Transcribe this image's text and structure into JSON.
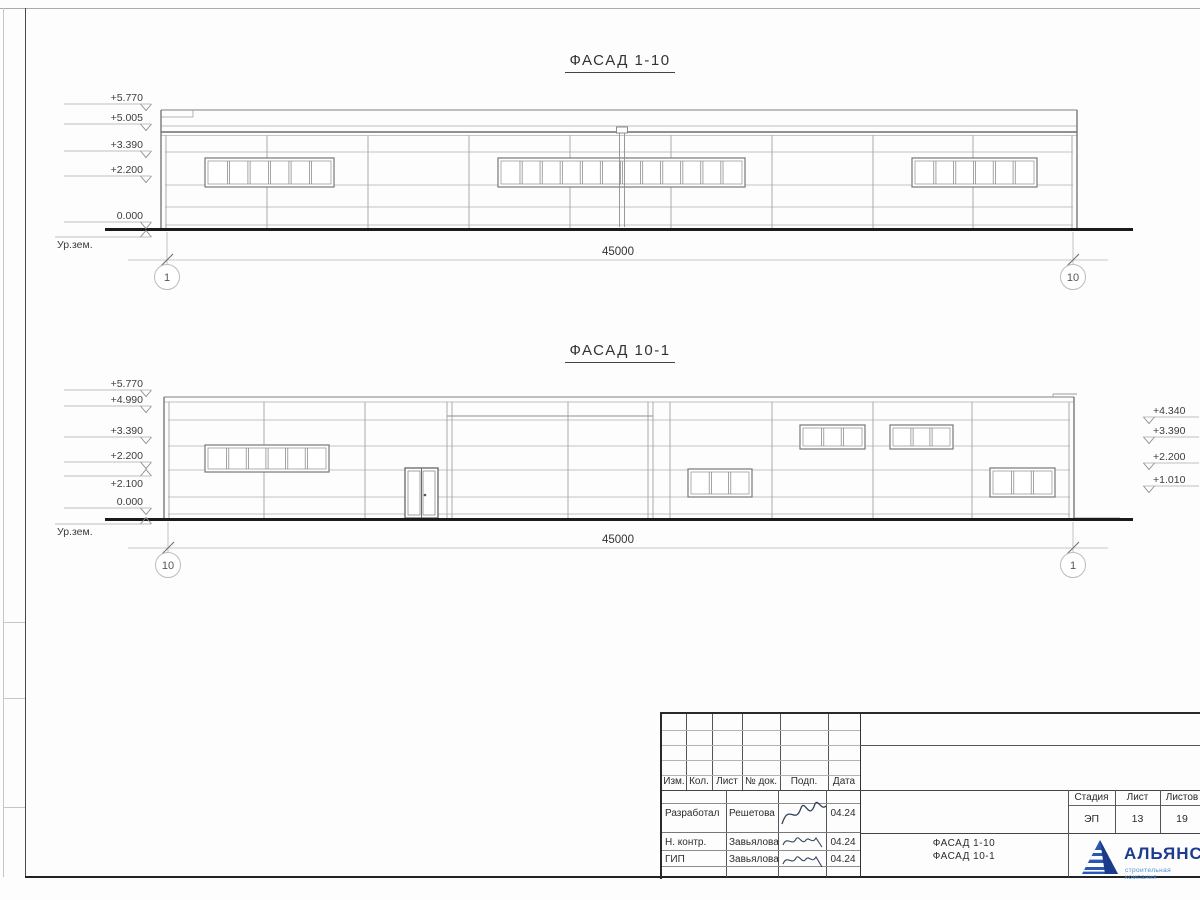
{
  "facades": [
    {
      "id": "facade-1-10",
      "title": "ФАСАД 1-10",
      "outline": {
        "x1": 161,
        "x2": 1077,
        "top": 110,
        "wall_top": 135,
        "ground": 228
      },
      "hlines": [
        152,
        185,
        207,
        225
      ],
      "vlines": [
        166,
        267,
        368,
        469,
        570,
        671,
        772,
        873,
        973,
        1072
      ],
      "lines": [
        [
          161,
          110,
          1077,
          110,
          1,
          "#7f7f7f"
        ],
        [
          161,
          117,
          193,
          117,
          0.8,
          "#9f9f9f"
        ],
        [
          193,
          110,
          193,
          117,
          0.8,
          "#9f9f9f"
        ],
        [
          161,
          126,
          1077,
          126,
          0.8,
          "#a8a8a8"
        ],
        [
          161,
          132,
          1077,
          132,
          1.4,
          "#6e6e6e"
        ],
        [
          161,
          135.5,
          1077,
          135.5,
          0.8,
          "#b5b5b5"
        ]
      ],
      "windows": [
        {
          "x": 205,
          "y": 158,
          "w": 129,
          "h": 29,
          "panes": 6
        },
        {
          "x": 498,
          "y": 158,
          "w": 247,
          "h": 29,
          "panes": 12
        },
        {
          "x": 912,
          "y": 158,
          "w": 125,
          "h": 29,
          "panes": 6
        }
      ],
      "downspout": {
        "x": 622,
        "cap_y": 127,
        "y1": 133,
        "y2": 227
      },
      "ground": {
        "x1": 105,
        "x2": 1133,
        "y": 229.5
      },
      "dim": {
        "y": 260,
        "lx1": 128,
        "lx2": 1108,
        "x1": 167,
        "x2": 1073,
        "label": "45000",
        "label_x": 618
      },
      "bubble_y": 277,
      "bubbles": [
        {
          "x": 167,
          "label": "1"
        },
        {
          "x": 1073,
          "label": "10"
        }
      ],
      "marks_left": [
        {
          "label": "+5.770",
          "y": 104
        },
        {
          "label": "+5.005",
          "y": 124
        },
        {
          "label": "+3.390",
          "y": 151
        },
        {
          "label": "+2.200",
          "y": 176
        },
        {
          "label": "0.000",
          "y": 222
        },
        {
          "label": "Ур.зем.",
          "y": 237,
          "flip": true,
          "ground": true
        }
      ],
      "marks_right": []
    },
    {
      "id": "facade-10-1",
      "title": "ФАСАД 10-1",
      "outline": {
        "x1": 164,
        "x2": 1074,
        "top": 397,
        "wall_top": 402,
        "ground": 518
      },
      "hlines": [
        420,
        446,
        470,
        497,
        514
      ],
      "vlines": [
        169,
        264,
        365,
        447,
        452,
        568,
        648,
        653,
        670,
        772,
        873,
        972,
        1069
      ],
      "lines": [
        [
          164,
          397,
          1074,
          397,
          1,
          "#7f7f7f"
        ],
        [
          164,
          402,
          1074,
          402,
          0.8,
          "#a8a8a8"
        ],
        [
          447,
          416,
          653,
          416,
          1,
          "#8f8f8f"
        ],
        [
          1053,
          394,
          1077,
          394,
          0.9,
          "#9a9a9a"
        ],
        [
          1053,
          394,
          1053,
          397,
          0.8,
          "#9a9a9a"
        ],
        [
          1074,
          518,
          1120,
          518,
          0.9,
          "#9a9a9a"
        ]
      ],
      "windows": [
        {
          "x": 205,
          "y": 445,
          "w": 124,
          "h": 27,
          "panes": 6
        },
        {
          "x": 688,
          "y": 469,
          "w": 64,
          "h": 28,
          "panes": 3
        },
        {
          "x": 800,
          "y": 425,
          "w": 65,
          "h": 24,
          "panes": 3
        },
        {
          "x": 890,
          "y": 425,
          "w": 63,
          "h": 24,
          "panes": 3
        },
        {
          "x": 990,
          "y": 468,
          "w": 65,
          "h": 29,
          "panes": 3
        }
      ],
      "door": {
        "x": 405,
        "y": 468,
        "w": 33,
        "h": 50
      },
      "ground": {
        "x1": 105,
        "x2": 1133,
        "y": 519.5
      },
      "dim": {
        "y": 548,
        "lx1": 128,
        "lx2": 1108,
        "x1": 168,
        "x2": 1073,
        "label": "45000",
        "label_x": 618
      },
      "bubble_y": 565,
      "bubbles": [
        {
          "x": 168,
          "label": "10"
        },
        {
          "x": 1073,
          "label": "1"
        }
      ],
      "marks_left": [
        {
          "label": "+5.770",
          "y": 390
        },
        {
          "label": "+4.990",
          "y": 406
        },
        {
          "label": "+3.390",
          "y": 437
        },
        {
          "label": "+2.200",
          "y": 462
        },
        {
          "label": "+2.100",
          "y": 476,
          "flip": true
        },
        {
          "label": "0.000",
          "y": 508
        },
        {
          "label": "Ур.зем.",
          "y": 524,
          "flip": true,
          "ground": true
        }
      ],
      "marks_right": [
        {
          "label": "+4.340",
          "y": 417
        },
        {
          "label": "+3.390",
          "y": 437
        },
        {
          "label": "+2.200",
          "y": 463
        },
        {
          "label": "+1.010",
          "y": 486
        }
      ]
    }
  ],
  "titleblock": {
    "header_cols": [
      "Изм.",
      "Кол.",
      "Лист",
      "№ док.",
      "Подп.",
      "Дата"
    ],
    "rows": [
      {
        "role": "Разработал",
        "name": "Решетова",
        "date": "04.24"
      },
      {
        "role": "Н. контр.",
        "name": "Завьялова",
        "date": "04.24"
      },
      {
        "role": "ГИП",
        "name": "Завьялова",
        "date": "04.24"
      }
    ],
    "stage_label": "Стадия",
    "sheet_label": "Лист",
    "sheets_label": "Листов",
    "stage_value": "ЭП",
    "sheet_value": "13",
    "sheets_value": "19",
    "doc_title_line1": "ФАСАД 1-10",
    "doc_title_line2": "ФАСАД 10-1",
    "logo_name": "АЛЬЯНС",
    "logo_subtitle": "строительная компания",
    "logo_color": "#1d3c8f",
    "logo_subtitle_color": "#4a8fd4"
  }
}
